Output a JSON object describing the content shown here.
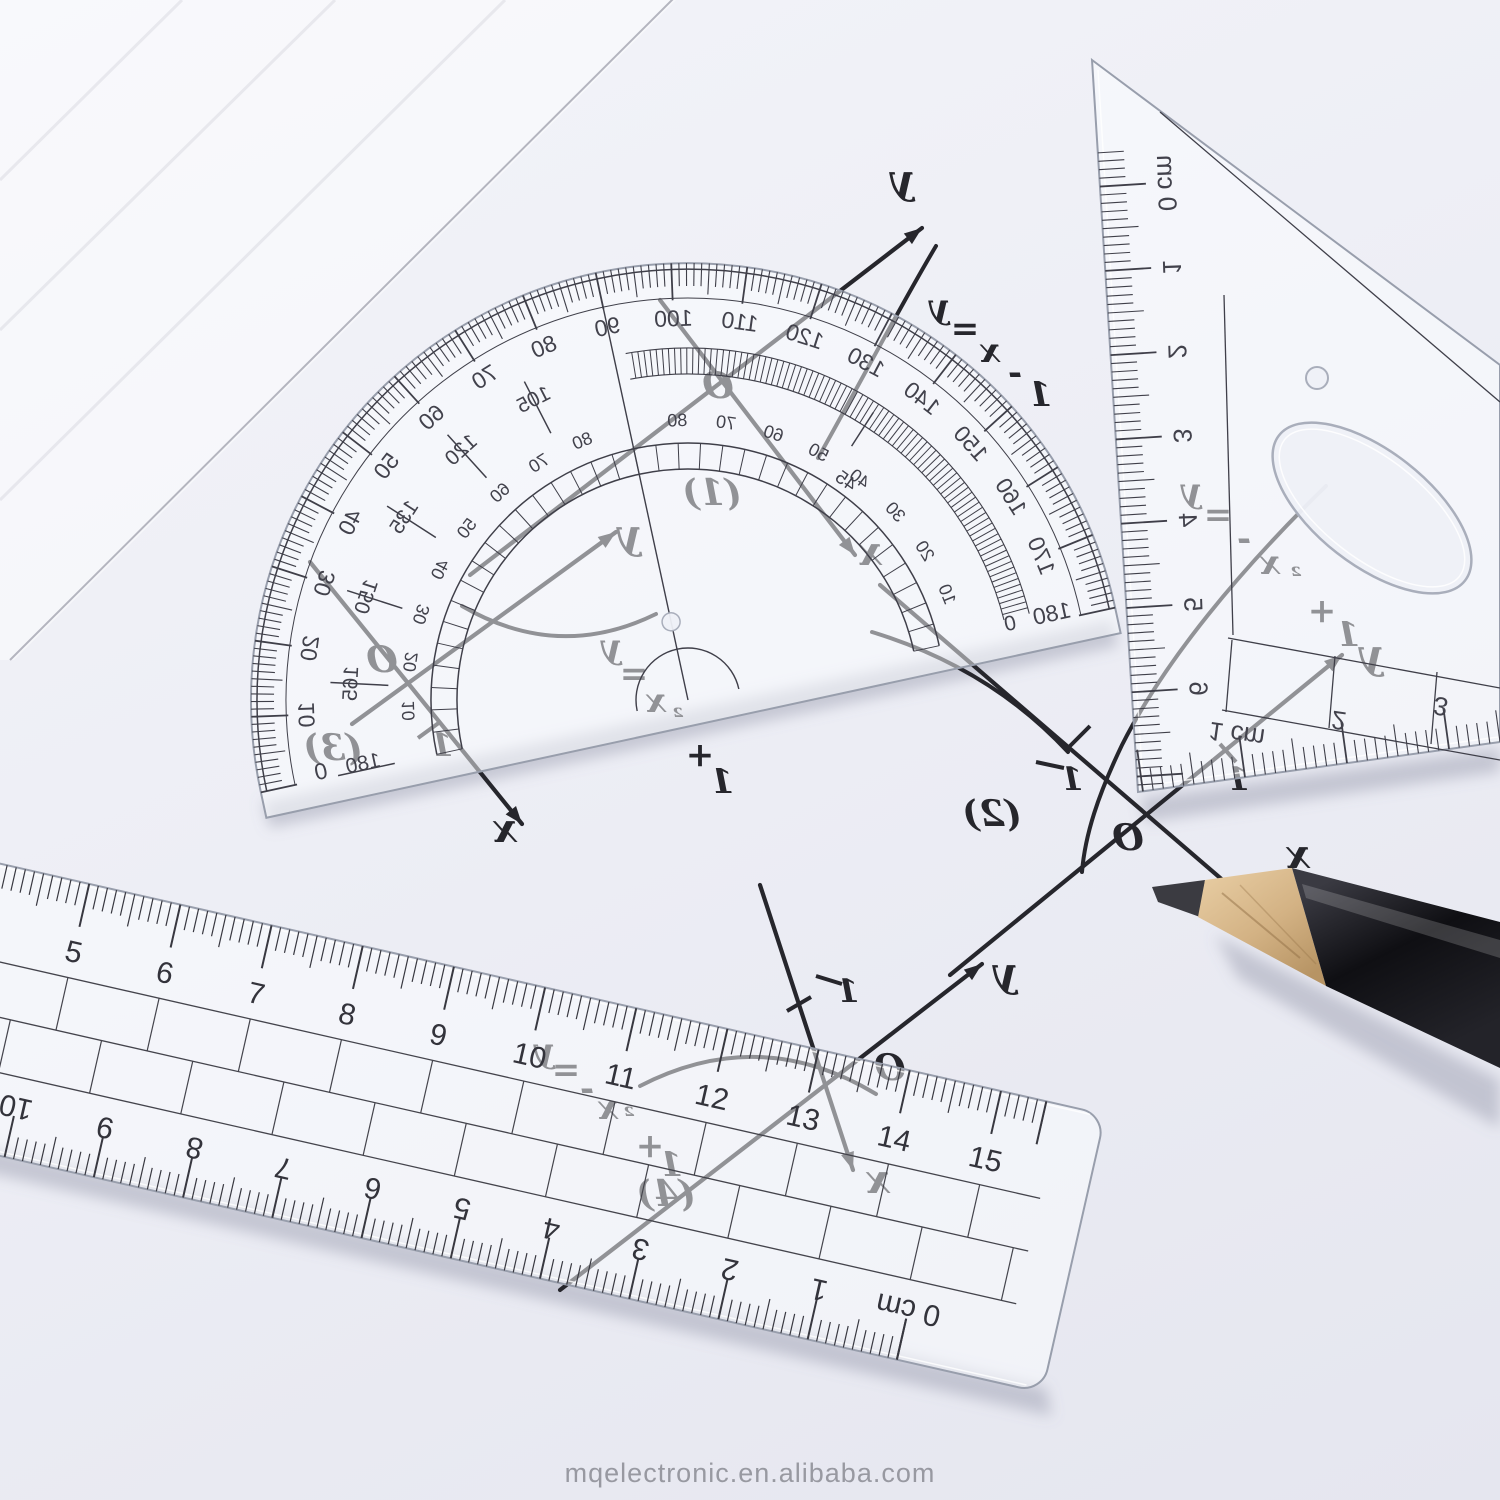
{
  "watermark": {
    "text": "mqelectronic.en.alibaba.com"
  },
  "colors": {
    "paper": "#edeef5",
    "ink": "#26262c",
    "print": "#3f3f49",
    "plastic_edge": "#989eac",
    "pencil_body": "#141418",
    "pencil_wood": "#d8ba8c",
    "pencil_lead": "#3b3b41",
    "watermark": "#8b8c94"
  },
  "protractor": {
    "outer_scale": [
      "0",
      "10",
      "20",
      "30",
      "40",
      "50",
      "60",
      "70",
      "80",
      "90",
      "100",
      "110",
      "120",
      "130",
      "140",
      "150",
      "160",
      "170",
      "180"
    ],
    "middle_scale": [
      "0",
      "105",
      "120",
      "135",
      "150",
      "165",
      "180"
    ],
    "special_mark": "45",
    "inner_scale": [
      "10",
      "20",
      "30",
      "40",
      "50",
      "60",
      "70",
      "80"
    ]
  },
  "triangle": {
    "side_scale": [
      "0 cm",
      "1",
      "2",
      "3",
      "4",
      "5",
      "6"
    ],
    "bottom_scale": [
      "1 cm",
      "2",
      "3"
    ]
  },
  "ruler": {
    "top_scale": [
      "5",
      "6",
      "7",
      "8",
      "9",
      "10",
      "11",
      "12",
      "13",
      "14",
      "15"
    ],
    "bottom_scale": [
      "10",
      "9",
      "8",
      "7",
      "6",
      "5",
      "4",
      "3",
      "2",
      "1",
      "0 cm"
    ]
  },
  "graphs": [
    {
      "label": "(1)",
      "equation": "y=x-1",
      "origin": "O",
      "x_label": "x",
      "y_label": "y",
      "ticks": []
    },
    {
      "label": "(2)",
      "equation": "y=-x²+1",
      "origin": "O",
      "x_label": "x",
      "y_label": "y",
      "ticks": [
        "-1",
        "1"
      ]
    },
    {
      "label": "(3)",
      "equation": "y=x²+1",
      "origin": "O",
      "x_label": "x",
      "y_label": "y",
      "ticks": [
        "1"
      ]
    },
    {
      "label": "(4)",
      "equation": "y=-x²+1",
      "origin": "O",
      "x_label": "x",
      "y_label": "y",
      "ticks": [
        "-1"
      ]
    }
  ]
}
